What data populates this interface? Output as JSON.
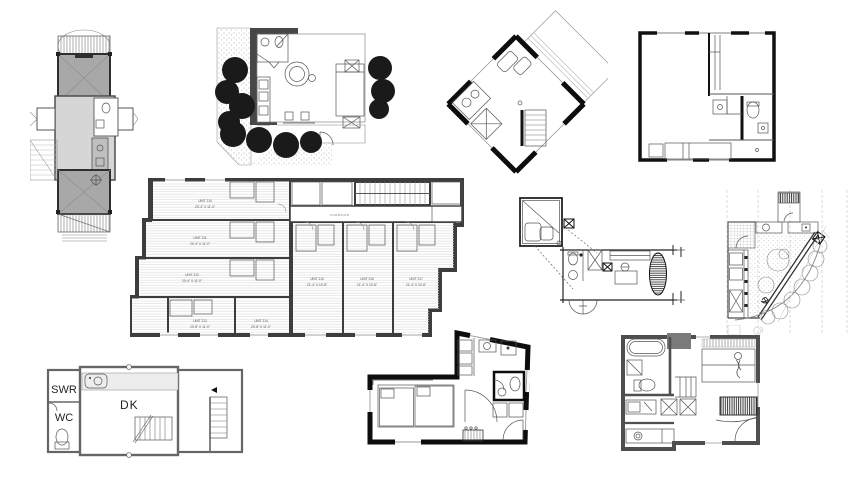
{
  "page": {
    "description_of_content": "collage of ten architectural floor plan drawings on white background"
  },
  "plans": {
    "apartment_floor": {
      "corridor_label": "CORRIDOR",
      "units": [
        {
          "label": "UNIT 210",
          "dims": "20'-4\" X 11'-0\""
        },
        {
          "label": "UNIT 211",
          "dims": "20'-4\" X 11'-0\""
        },
        {
          "label": "UNIT 212",
          "dims": "20'-4\" X 11'-0\""
        },
        {
          "label": "UNIT 213",
          "dims": "20'-8\" X 11'-0\""
        },
        {
          "label": "UNIT 214",
          "dims": "20'-8\" X 11'-0\""
        },
        {
          "label": "UNIT 215",
          "dims": "21'-4\" X 10'-8\""
        },
        {
          "label": "UNIT 216",
          "dims": "21'-4\" X 10'-8\""
        },
        {
          "label": "UNIT 217",
          "dims": "21'-4\" X 10'-8\""
        }
      ]
    },
    "swr_unit": {
      "shower_label": "SWR",
      "wc_label": "WC",
      "dk_label": "DK"
    }
  },
  "colors": {
    "background": "#ffffff",
    "wall_black": "#111111",
    "wall_dark_gray": "#3d3d3d",
    "wall_mid_gray": "#666666",
    "room_fill_gray": "#a8a8a8",
    "room_fill_light": "#d6d6d6",
    "tree_canopy": "#1a1a1a",
    "line_thin": "#555555"
  }
}
